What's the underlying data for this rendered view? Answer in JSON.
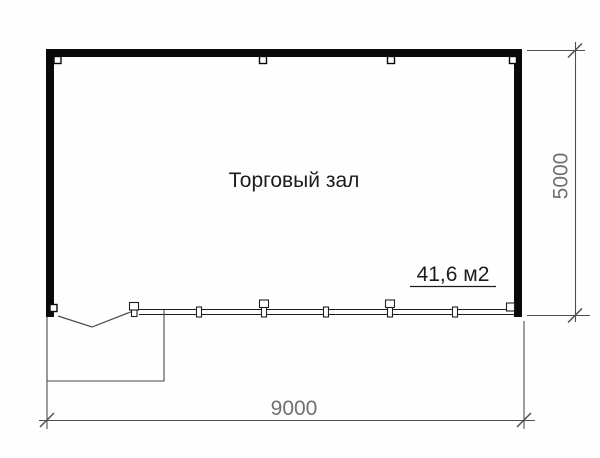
{
  "plan": {
    "room_label": "Торговый зал",
    "area_label": "41,6 м2",
    "width_dimension": "9000",
    "height_dimension": "5000",
    "colors": {
      "wall": "#0a0a0a",
      "glazing_line": "#1f1f1f",
      "outline": "#4a4a4a",
      "dimension_line": "#4f4f4f",
      "dimension_text": "#707070",
      "room_text": "#1c1c1c",
      "background": "#fefefe"
    }
  }
}
